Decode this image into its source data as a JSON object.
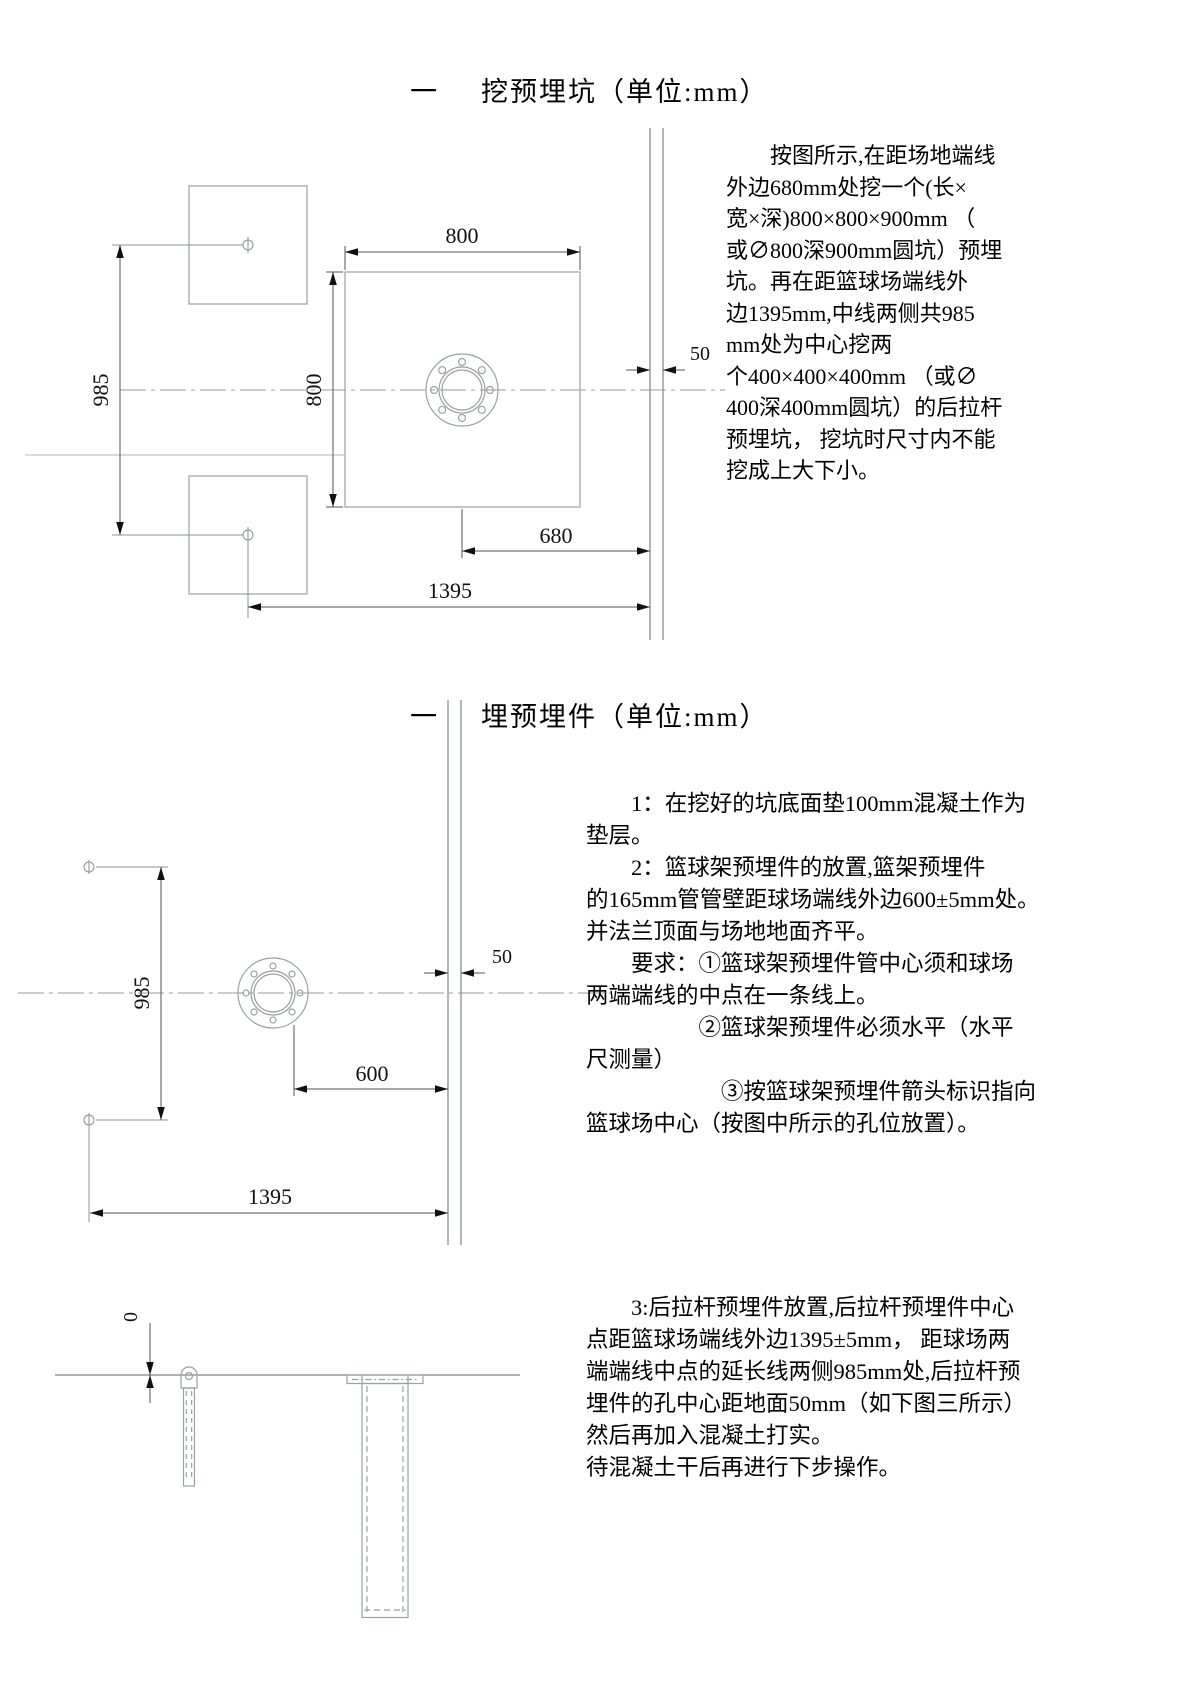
{
  "section1": {
    "title_prefix": "一",
    "title_text": "挖预埋坑（单位:mm）",
    "paragraph": "　　按图所示,在距场地端线\n外边680mm处挖一个(长×\n宽×深)800×800×900mm （\n或∅800深900mm圆坑）预埋\n坑。再在距篮球场端线外\n边1395mm,中线两侧共985\nmm处为中心挖两\n个400×400×400mm （或∅\n400深400mm圆坑）的后拉杆\n预埋坑， 挖坑时尺寸内不能\n挖成上大下小。",
    "dims": {
      "width_800": "800",
      "height_800": "800",
      "offset_985": "985",
      "offset_680": "680",
      "offset_1395": "1395",
      "gap_50": "50"
    }
  },
  "section2": {
    "title_prefix": "一",
    "title_text": "埋预埋件（单位:mm）",
    "paragraph": "　　1：在挖好的坑底面垫100mm混凝土作为\n垫层。\n　　2：篮球架预埋件的放置,篮架预埋件\n的165mm管管壁距球场端线外边600±5mm处。\n并法兰顶面与场地地面齐平。\n　　要求：①篮球架预埋件管中心须和球场\n两端端线的中点在一条线上。\n　　　　　②篮球架预埋件必须水平（水平\n尺测量）\n　　　　　　③按篮球架预埋件箭头标识指向\n篮球场中心（按图中所示的孔位放置）。",
    "dims": {
      "offset_985": "985",
      "offset_600": "600",
      "offset_1395": "1395",
      "gap_50": "50"
    }
  },
  "section3": {
    "paragraph": "　　3:后拉杆预埋件放置,后拉杆预埋件中心\n点距篮球场端线外边1395±5mm， 距球场两\n端端线中点的延长线两侧985mm处,后拉杆预\n埋件的孔中心距地面50mm（如下图三所示）\n然后再加入混凝土打实。\n待混凝土干后再进行下步操作。",
    "dims": {
      "zero": "0"
    }
  },
  "colors": {
    "geometry": "#9aa0a4",
    "dimension": "#555555",
    "arrow": "#111111",
    "centerline": "#999999",
    "court_line": "#808487"
  }
}
